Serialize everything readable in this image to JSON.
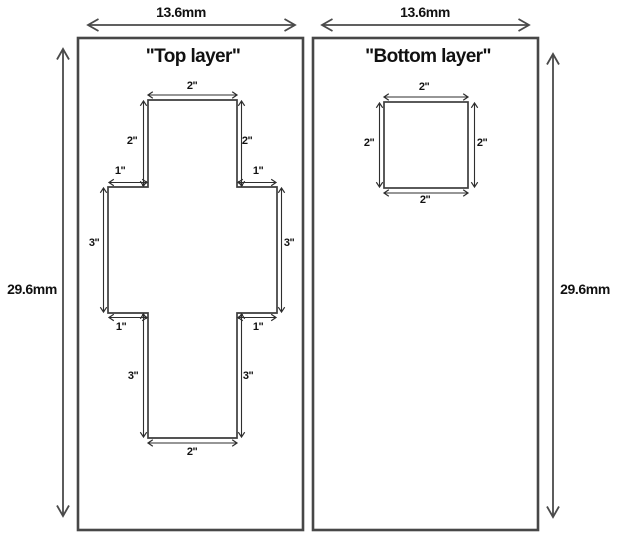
{
  "colors": {
    "background": "#ffffff",
    "panel_outline": "#474747",
    "trace_line": "#3d3d3d",
    "dimension_line": "#2e2e2e",
    "text": "#111111"
  },
  "top_layer": {
    "title": "\"Top layer\"",
    "width_label": "13.6mm",
    "height_label": "29.6mm",
    "dims": {
      "top_width": "2\"",
      "upper_left_height": "2\"",
      "upper_right_height": "2\"",
      "upper_left_notch": "1\"",
      "upper_right_notch": "1\"",
      "mid_left_height": "3\"",
      "mid_right_height": "3\"",
      "lower_left_notch": "1\"",
      "lower_right_notch": "1\"",
      "lower_left_height": "3\"",
      "lower_right_height": "3\"",
      "bottom_width": "2\""
    }
  },
  "bottom_layer": {
    "title": "\"Bottom layer\"",
    "width_label": "13.6mm",
    "height_label": "29.6mm",
    "dims": {
      "top_width": "2\"",
      "left_height": "2\"",
      "right_height": "2\"",
      "bottom_width": "2\""
    }
  }
}
